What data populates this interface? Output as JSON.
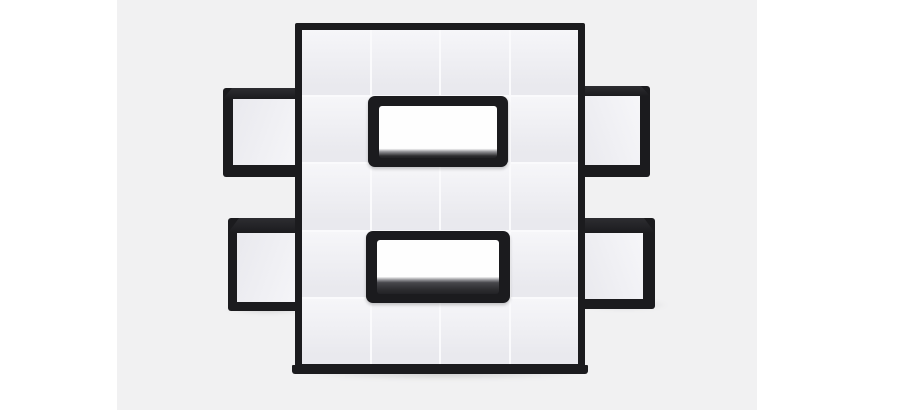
{
  "scene": {
    "description": "Studio product photograph of a black modular cube shelving unit arranged in a pixelated figure-eight shape with white front panels",
    "subject": "pixel-style cube bookshelf"
  },
  "shelf": {
    "grid_columns": 4,
    "grid_rows": 5,
    "open_niches": 2,
    "side_wings": 4
  },
  "colors": {
    "page_background": "#ffffff",
    "photo_background": "#f1f1f2",
    "frame_black": "#1b1b1e",
    "frame_top_face": "#2d2d31",
    "panel_light": "#f6f6f9",
    "panel_dark": "#e9e9ee",
    "panel_seam": "#fafafc",
    "niche_interior": "#fefefe",
    "niche_shelf_mid": "#8e8e93",
    "niche_shelf_dark": "#2c2c2f"
  }
}
